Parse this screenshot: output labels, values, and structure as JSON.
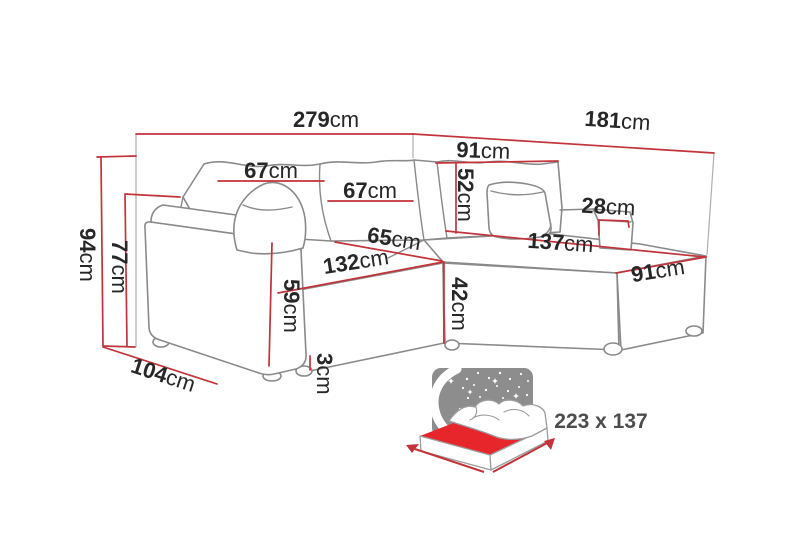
{
  "dimensions": {
    "total_width": {
      "num": "279",
      "unit": "cm"
    },
    "total_depth": {
      "num": "181",
      "unit": "cm"
    },
    "right_back_cushion_width": {
      "num": "91",
      "unit": "cm"
    },
    "left_back_cushion_width": {
      "num": "67",
      "unit": "cm"
    },
    "middle_back_cushion_width": {
      "num": "67",
      "unit": "cm"
    },
    "back_cushion_height": {
      "num": "52",
      "unit": "cm"
    },
    "right_armrest_width": {
      "num": "28",
      "unit": "cm"
    },
    "chaise_length": {
      "num": "137",
      "unit": "cm"
    },
    "chaise_end_width": {
      "num": "91",
      "unit": "cm"
    },
    "seat_depth": {
      "num": "65",
      "unit": "cm"
    },
    "seat_width": {
      "num": "132",
      "unit": "cm"
    },
    "seat_height": {
      "num": "42",
      "unit": "cm"
    },
    "armrest_height": {
      "num": "59",
      "unit": "cm"
    },
    "leg_height": {
      "num": "3",
      "unit": "cm"
    },
    "total_height": {
      "num": "94",
      "unit": "cm"
    },
    "backrest_height": {
      "num": "77",
      "unit": "cm"
    },
    "side_depth": {
      "num": "104",
      "unit": "cm"
    }
  },
  "sleeping_area": {
    "label": "223 x 137"
  },
  "colors": {
    "dimension_line": "#c2333a",
    "mattress_red": "#e6262b",
    "sofa_outline": "#8a8a8a",
    "label_text": "#272727",
    "sleeping_label_text": "#4d4d4d",
    "night_sky_gray": "#8d8d8d"
  }
}
